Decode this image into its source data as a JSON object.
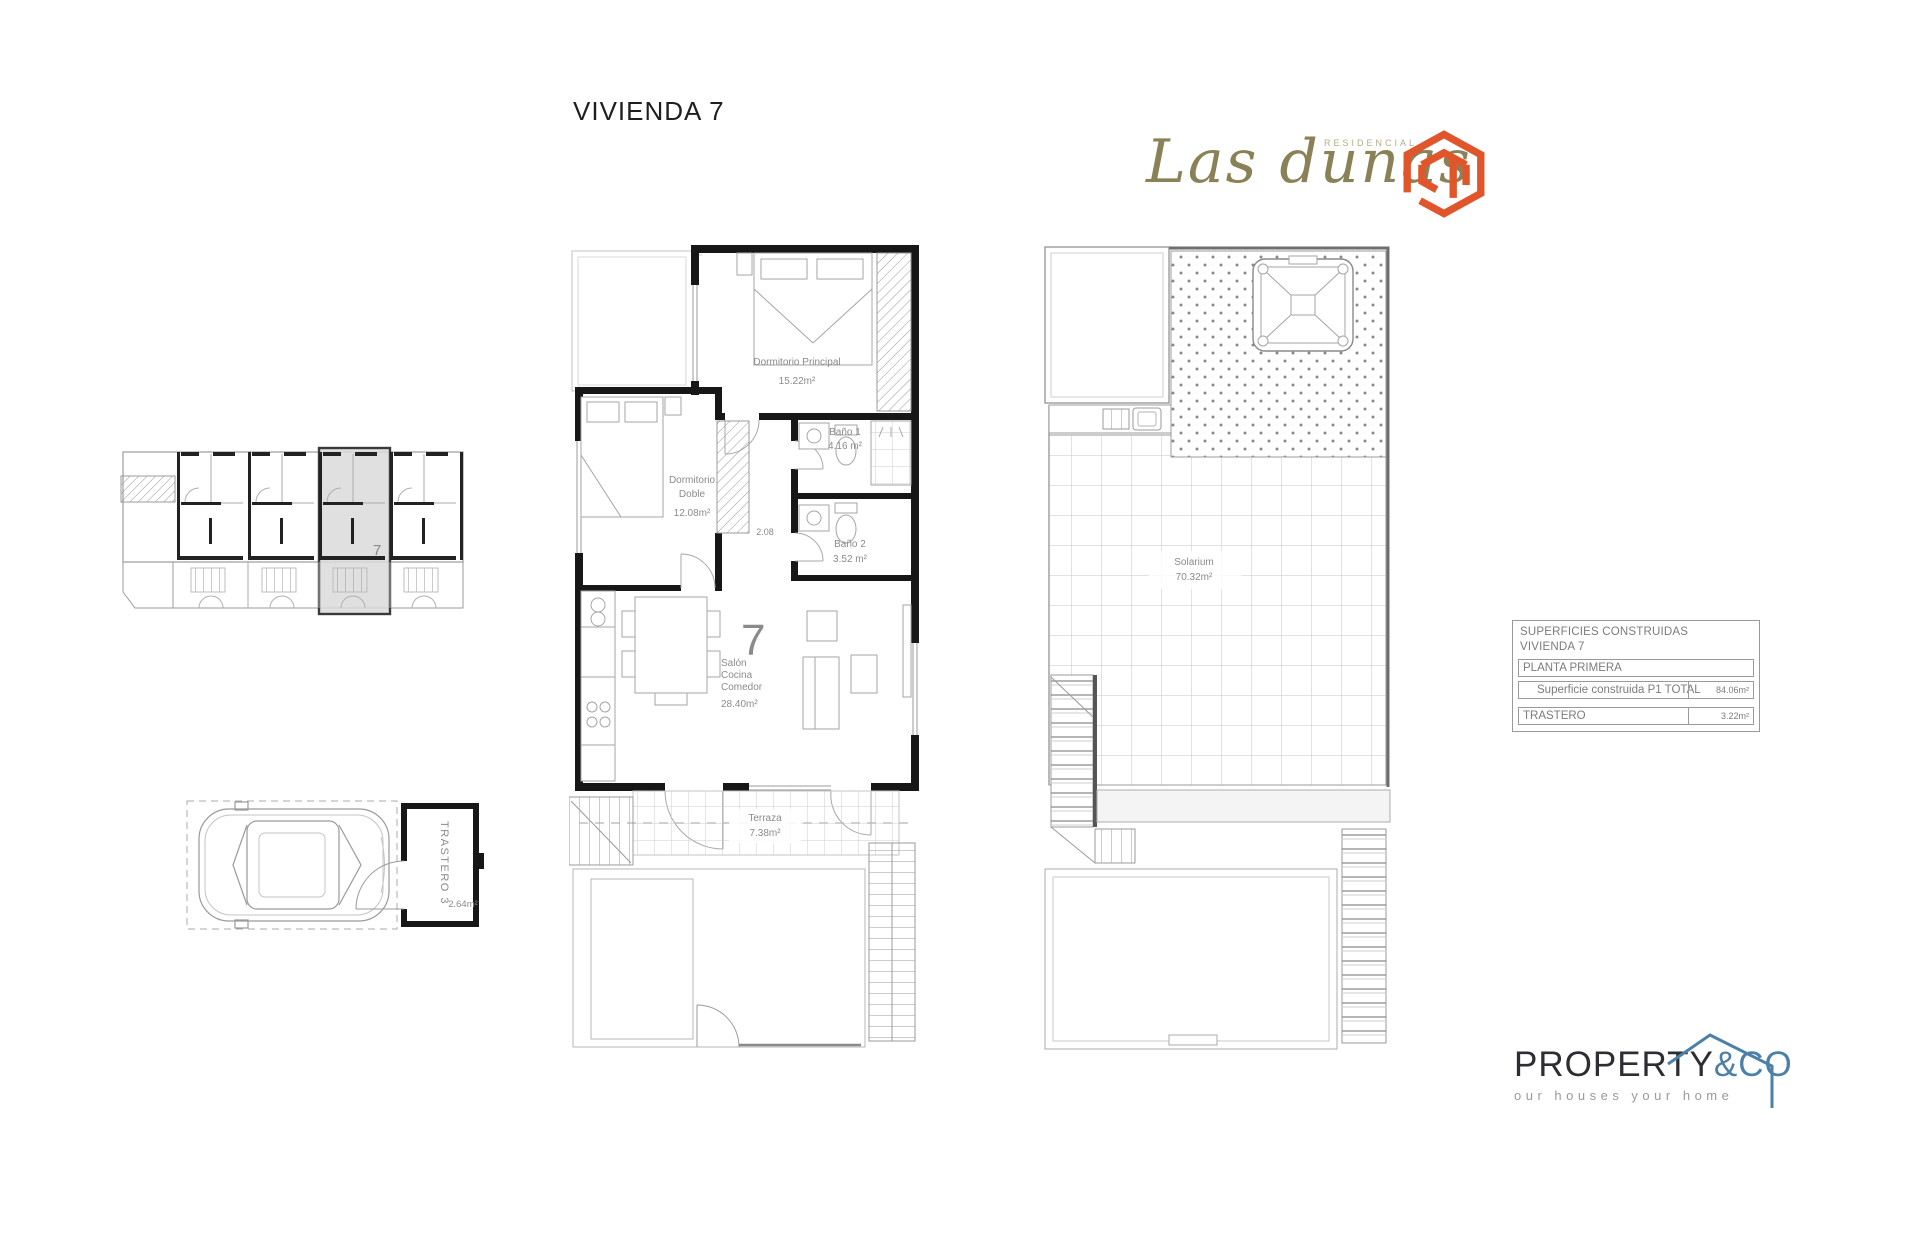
{
  "page": {
    "title": "VIVIENDA 7"
  },
  "brand": {
    "name": "Las dunas",
    "residencial": "RESIDENCIAL",
    "olive_color": "#8a8157",
    "icon_color": "#e0552a",
    "icon": "cube-ribbon-logo-icon"
  },
  "site_plan": {
    "unit": "7"
  },
  "main_plan": {
    "unit_number": "7",
    "unit_number_color": "#c0182f",
    "dormitorio_principal": {
      "name": "Dormitorio Principal",
      "area": "15.22m²"
    },
    "bano_1": {
      "name": "Baño 1",
      "area": "4.16 m²"
    },
    "dormitorio_doble": {
      "name_line1": "Dormitorio",
      "name_line2": "Doble",
      "area": "12.08m²"
    },
    "pasillo_dim": "2.08",
    "bano_2": {
      "name": "Baño 2",
      "area": "3.52 m²"
    },
    "salon": {
      "name_line1": "Salón",
      "name_line2": "Cocina",
      "name_line3": "Comedor",
      "area": "28.40m²"
    },
    "terraza": {
      "name": "Terraza",
      "area": "7.38m²"
    }
  },
  "roof_plan": {
    "solarium": {
      "name": "Solarium",
      "area": "70.32m²"
    }
  },
  "garage": {
    "trastero": {
      "name": "TRASTERO 3",
      "area": "2.64m²"
    }
  },
  "areas_table": {
    "title_line1": "SUPERFICIES CONSTRUIDAS",
    "title_line2": "VIVIENDA 7",
    "planta_row": "PLANTA PRIMERA",
    "superficie_row": {
      "label": "Superficie construida P1 TOTAL",
      "value": "84.06m²"
    },
    "trastero_row": {
      "label": "TRASTERO",
      "value": "3.22m²"
    }
  },
  "footer_brand": {
    "name": "PROPERTY",
    "suffix": "&CO",
    "tagline": "our houses your home",
    "primary_color": "#2d2d34",
    "secondary_color": "#4b80a8"
  }
}
